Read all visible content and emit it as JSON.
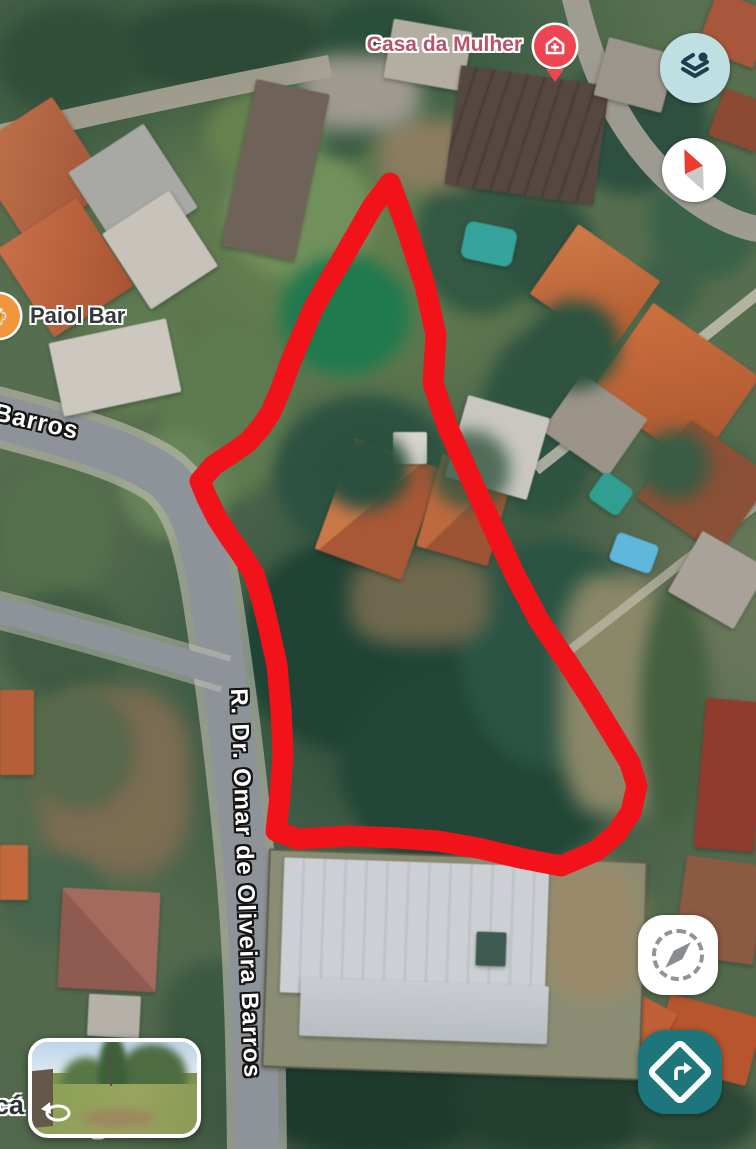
{
  "map": {
    "view": "satellite",
    "pois": [
      {
        "id": "casa-da-mulher",
        "label": "Casa da Mulher",
        "icon": "health-house-cross-icon",
        "pin_color": "#ee4553",
        "label_color": "#b6556a"
      },
      {
        "id": "paiol-bar",
        "label": "Paiol Bar",
        "icon": "food-drink-poi-icon",
        "icon_color": "#f2953c",
        "label_color": "#33383c"
      }
    ],
    "street_labels": [
      {
        "id": "barros",
        "text": "Barros"
      },
      {
        "id": "omar-de-oliveira-barros",
        "text": "R. Dr. Omar de Oliveira Barros"
      },
      {
        "id": "occluded-fragment-left",
        "text": "cá"
      },
      {
        "id": "occluded-fragment-bottom",
        "text": "gão"
      }
    ],
    "annotation": {
      "shape": "freehand-outline",
      "color": "#f2121a"
    }
  },
  "controls": {
    "layers_button": {
      "icon": "layers-icon",
      "bg": "#bfe0e2",
      "glyph_color": "#1c3e4e"
    },
    "compass_button": {
      "icon": "compass-needle-icon",
      "north_color": "#ec3b2f"
    },
    "my_location_button": {
      "icon": "location-searching-icon"
    },
    "directions_button": {
      "icon": "turn-right-diamond-icon",
      "bg": "#1d767c"
    }
  },
  "street_view_preview": {
    "icon": "pan-around-icon",
    "description": "street-view-thumbnail"
  }
}
